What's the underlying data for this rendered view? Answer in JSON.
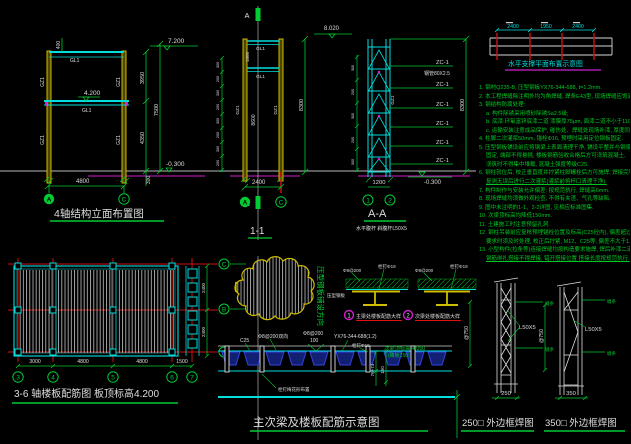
{
  "colors": {
    "yellow": "#d0bd00",
    "cyan": "#00dede",
    "green": "#00cc33",
    "magenta": "#cc22cc",
    "red": "#cc1111",
    "white": "#dedede",
    "blue": "#2239c0"
  },
  "elev": {
    "title": "4轴结构立面布置图",
    "level_top": "7.200",
    "level_mid": "4.200",
    "level_ground": "-0.300",
    "dim_400": "400",
    "dim_3950": "3950",
    "dim_4350": "4350",
    "dim_7500": "7500",
    "dim_4800": "4800",
    "dim_300": "300",
    "beam1": "GL1",
    "beam2": "GL1",
    "col1": "GZ1",
    "col2": "GZ1",
    "col3": "GZ1",
    "col4": "GZ1",
    "bubble_a": "A",
    "bubble_c": "C"
  },
  "s11": {
    "title": "1-1",
    "marker_top": "A",
    "marker_bot": "A",
    "level": "8.020",
    "dim_total": "8300",
    "dim_inner": "8600",
    "dim_beam": "1800",
    "dim_width": "2400",
    "beam1": "GL1",
    "beam2": "GL1",
    "col1": "GZ1",
    "col2": "GZ1",
    "bubble_a": "A",
    "bubble_c": "C",
    "ticks": [
      "300",
      "200",
      "300",
      "200",
      "300",
      "200",
      "300",
      "200"
    ]
  },
  "aa": {
    "title": "A-A",
    "sub": "水平腹杆 斜腹杆L50X5",
    "zc": [
      "ZC-1",
      "ZC-1",
      "ZC-1",
      "ZC-1",
      "ZC-1",
      "ZC-1"
    ],
    "pipe": "钢管80X2.5",
    "col": "GZ1",
    "dim_total": "8300",
    "dim_width": "1200",
    "level": "-0.300",
    "b1": "1",
    "b2": "2",
    "ticks": [
      "300",
      "200",
      "300",
      "200",
      "300"
    ]
  },
  "plan_top": {
    "title": "水平支撑平面布置示意图",
    "dims": [
      "2400",
      "1950",
      "2400"
    ]
  },
  "notes": {
    "lines": [
      {
        "t": "1. 钢材Q235-B, 压型钢板YX76-344-688, t=1.2mm."
      },
      {
        "t": "2. 本工程焊缝除注明外均为角焊缝, 焊条E43型, 现场焊缝应饱满."
      },
      {
        "t": "3. 钢结构防腐处理:"
      },
      {
        "t": "a. 构件除锈采用喷砂除锈Sa2.5级;",
        "i": true
      },
      {
        "t": "b. 底漆:环氧富锌底漆二道 漆膜厚75μm, 面漆二道不小于110μm;",
        "i": true
      },
      {
        "t": "c. 运输安装注意成品保护, 碰伤处、焊缝处现场补漆, 厚度同上;",
        "i": true
      },
      {
        "t": "4. 柱脚二次灌浆50mm, 锚栓Φ16, 预埋时采用定位钢板固定."
      },
      {
        "t": "5. 压型钢板铺设前应将钢梁上表面清理干净, 铺设平整并与钢梁点焊"
      },
      {
        "t": "固定, 端部不得悬挑, 楼板钢筋验收合格后方可浇筑混凝土,",
        "i": true
      },
      {
        "t": "浇筑时不得集中堆载, 混凝土强度等级C25.",
        "i": true
      },
      {
        "t": "6. 钢柱就位后, 校正垂直度并拧紧柱脚螺栓后方可施焊, 焊接完毕"
      },
      {
        "t": "复测无误后进行二次灌浆(灌浆前将杯口清理干净).",
        "i": true,
        "u": true
      },
      {
        "t": "7. 构件制作与安装允许偏差: 按规范执行, 焊缝高6mm."
      },
      {
        "t": "8. 现场焊缝均须做外观检查, 不得有夹渣、气孔等缺陷."
      },
      {
        "t": "9. 图中未注明的1-1、2-2详图, 见相应标准图集."
      },
      {
        "t": "10. 次梁顶标高均降低150mm."
      },
      {
        "t": "11. 土建施工时注意预留孔洞."
      },
      {
        "t": "12. 钢柱吊装前应复核预埋锚栓位置及标高(C25砼内), 偏差超过规范"
      },
      {
        "t": "要求时须及时处理, 校正后拧紧, M12、C25等, 偏差不大于1.0mm.",
        "i": true
      },
      {
        "t": "13. 小型构件(拉条等)连接焊缝均按构造要求施焊, 焊后补漆二道,"
      },
      {
        "t": "钢筋绑扎搭接不得焊接, 错开搭接位置 搭接长度按规范执行.",
        "i": true,
        "u": true
      }
    ]
  },
  "plan_bl": {
    "title": "3-6 轴楼板配筋图 板顶标高4.200",
    "bubbles": [
      "3",
      "4",
      "5",
      "6",
      "7"
    ],
    "dims": [
      "3000",
      "4800",
      "4800",
      "1500"
    ],
    "right_dims": [
      "2400",
      "2400"
    ]
  },
  "bc": {
    "rowC": "C",
    "rowB": "B",
    "rowA": "A",
    "blob_label": "压型钢板铺设方向",
    "d1_num": "1",
    "d1_label": "主梁处楼板配筋大样",
    "d2_num": "2",
    "d2_label": "次梁处楼板配筋大样",
    "d1_t1": "Φ8@200",
    "d1_t2": "栓钉Φ19",
    "d1_t3": "压型钢板",
    "d2_t1": "Φ8@200",
    "d2_t2": "栓钉Φ19",
    "s_c25": "C25",
    "s_mesh": "Φ8@200双向",
    "s_neg": "Φ8@200",
    "s_neg2": "100",
    "s_sheet": "YX76-344-688(1.2)",
    "s_stud": "栓钉Φ19",
    "s_level1": "次梁顶标高 4.050",
    "s_level2": "(降板150)",
    "s_d1": "76+74",
    "s_d2": "150",
    "s_below": "栓钉梅花形布置",
    "title": "主次梁及楼板配筋示意图"
  },
  "br": {
    "t250": "250□ 外边框焊图",
    "t350": "350□ 外边框焊图",
    "w250": "250",
    "w350": "350",
    "p1": "@750",
    "p2": "@750",
    "a1": "L50X5",
    "a2": "L50X5",
    "tag1": "缀条",
    "tag2": "缀条",
    "tag3": "缀条",
    "tag4": "缀条"
  }
}
